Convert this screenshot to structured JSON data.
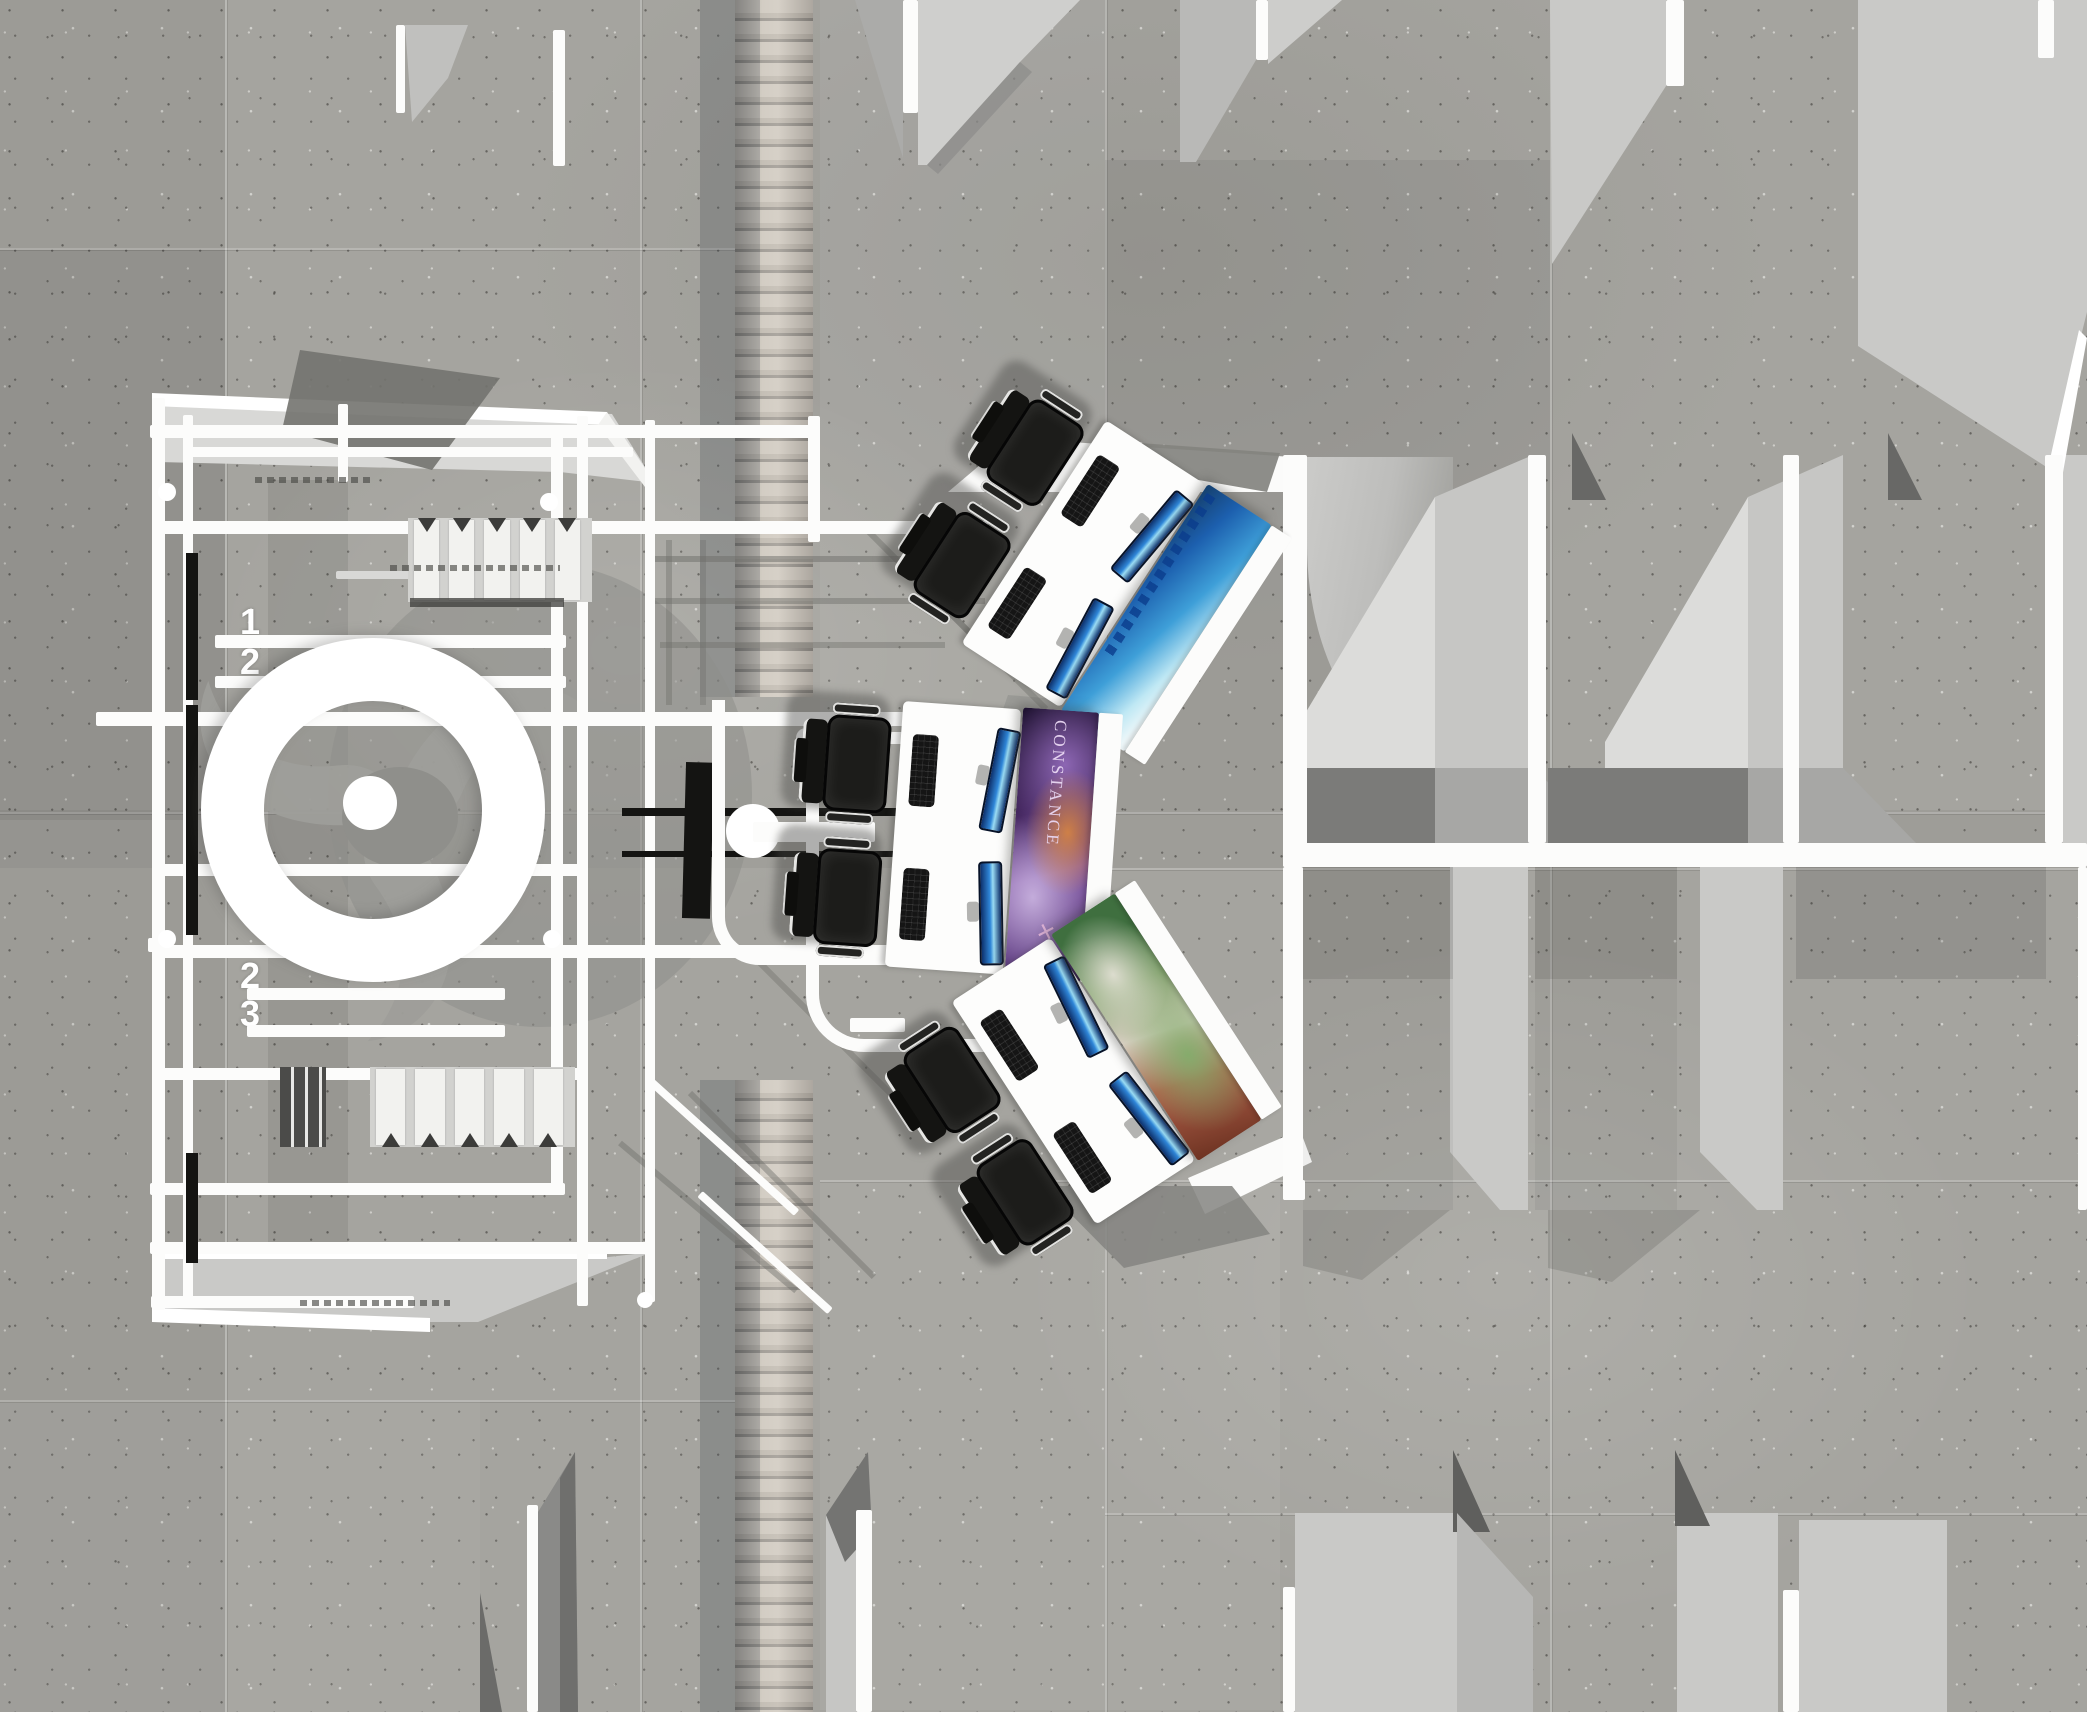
{
  "meta": {
    "scene": "top-down 3d render of exhibition gaming booth floor plan",
    "view": "plan"
  },
  "canvas": {
    "w": 2087,
    "h": 1712
  },
  "palette": {
    "concrete": "#a5a49f",
    "white": "#fcfcfb",
    "light_panel": "#c9c9c7",
    "mid_gray": "#a7a7a5",
    "dark_shadow": "#7b7b79",
    "chair_black": "#1c1c1a",
    "monitor_blue": "#2f86d8",
    "monitor_glow": "#9adcf4",
    "wood_light": "#c9c2b8",
    "poster_purple": "#7a4f9e",
    "poster_blue": "#3e9fd8",
    "poster_green": "#7fa06a"
  },
  "floor": {
    "seams_v": [
      {
        "x": 225,
        "y": 0,
        "h": 1712
      },
      {
        "x": 640,
        "y": 0,
        "h": 1712
      },
      {
        "x": 1105,
        "y": 0,
        "h": 1712
      },
      {
        "x": 1550,
        "y": 0,
        "h": 1712
      }
    ],
    "seams_h": [
      {
        "y": 248,
        "x": 0,
        "w": 735
      },
      {
        "y": 812,
        "x": 0,
        "w": 2087
      },
      {
        "y": 868,
        "x": 1105,
        "w": 982
      },
      {
        "y": 1180,
        "x": 820,
        "w": 1267
      },
      {
        "y": 1400,
        "x": 0,
        "w": 735
      },
      {
        "y": 1513,
        "x": 1105,
        "w": 982
      }
    ],
    "tones": [
      {
        "x": 0,
        "y": 0,
        "w": 225,
        "h": 1712,
        "c": "#000000",
        "o": 0.05
      },
      {
        "x": 0,
        "y": 250,
        "w": 225,
        "h": 570,
        "c": "#000000",
        "o": 0.06
      },
      {
        "x": 820,
        "y": 0,
        "w": 285,
        "h": 810,
        "c": "#ffffff",
        "o": 0.05
      },
      {
        "x": 1105,
        "y": 160,
        "w": 445,
        "h": 650,
        "c": "#000000",
        "o": 0.05
      },
      {
        "x": 0,
        "y": 810,
        "w": 2087,
        "h": 58,
        "c": "#000000",
        "o": 0.04
      },
      {
        "x": 820,
        "y": 1180,
        "w": 460,
        "h": 530,
        "c": "#ffffff",
        "o": 0.05
      },
      {
        "x": 0,
        "y": 1400,
        "w": 480,
        "h": 312,
        "c": "#ffffff",
        "o": 0.04
      },
      {
        "x": 268,
        "y": 480,
        "w": 80,
        "h": 770,
        "c": "#000000",
        "o": 0.08
      }
    ]
  },
  "walkway": {
    "x": 735,
    "w": 78,
    "segments": [
      {
        "y": 0,
        "h": 697
      },
      {
        "y": 1080,
        "h": 632
      }
    ],
    "shadow_x": 700,
    "shadow_w": 60
  },
  "booth": {
    "numbers": [
      {
        "label": "1",
        "x": 240,
        "y": 604
      },
      {
        "label": "2",
        "x": 240,
        "y": 644
      },
      {
        "label": "2",
        "x": 240,
        "y": 958
      },
      {
        "label": "3",
        "x": 240,
        "y": 996
      }
    ],
    "beams_h": [
      {
        "x": 150,
        "y": 425,
        "w": 662,
        "h": 13
      },
      {
        "x": 183,
        "y": 447,
        "w": 450,
        "h": 10
      },
      {
        "x": 163,
        "y": 521,
        "w": 825,
        "h": 13
      },
      {
        "x": 336,
        "y": 571,
        "w": 246,
        "h": 8,
        "c": "#d8d8d6"
      },
      {
        "x": 215,
        "y": 635,
        "w": 351,
        "h": 13
      },
      {
        "x": 215,
        "y": 676,
        "w": 351,
        "h": 12
      },
      {
        "x": 96,
        "y": 712,
        "w": 812,
        "h": 14
      },
      {
        "x": 820,
        "y": 732,
        "w": 92,
        "h": 12
      },
      {
        "x": 163,
        "y": 864,
        "w": 419,
        "h": 12
      },
      {
        "x": 163,
        "y": 945,
        "w": 745,
        "h": 13
      },
      {
        "x": 247,
        "y": 988,
        "w": 258,
        "h": 12
      },
      {
        "x": 247,
        "y": 1025,
        "w": 258,
        "h": 12
      },
      {
        "x": 163,
        "y": 1068,
        "w": 419,
        "h": 12
      },
      {
        "x": 150,
        "y": 1183,
        "w": 415,
        "h": 12
      },
      {
        "x": 150,
        "y": 1242,
        "w": 497,
        "h": 12
      },
      {
        "x": 151,
        "y": 1296,
        "w": 263,
        "h": 12
      },
      {
        "x": 850,
        "y": 1018,
        "w": 55,
        "h": 14
      },
      {
        "x": 148,
        "y": 938,
        "w": 18,
        "h": 14
      }
    ],
    "beams_v": [
      {
        "x": 152,
        "y": 398,
        "w": 13,
        "h": 912
      },
      {
        "x": 183,
        "y": 415,
        "w": 10,
        "h": 886
      },
      {
        "x": 338,
        "y": 404,
        "w": 10,
        "h": 78
      },
      {
        "x": 551,
        "y": 428,
        "w": 12,
        "h": 762
      },
      {
        "x": 577,
        "y": 416,
        "w": 11,
        "h": 890
      },
      {
        "x": 645,
        "y": 420,
        "w": 10,
        "h": 882
      },
      {
        "x": 808,
        "y": 416,
        "w": 12,
        "h": 126
      },
      {
        "x": 553,
        "y": 30,
        "w": 12,
        "h": 136
      },
      {
        "x": 396,
        "y": 25,
        "w": 9,
        "h": 88
      }
    ],
    "diag_white": [
      {
        "x": 648,
        "y": 1075,
        "w": 200,
        "h": 8,
        "rot": 42
      },
      {
        "x": 700,
        "y": 1190,
        "w": 175,
        "h": 8,
        "rot": 42
      }
    ],
    "diag_gray": [
      {
        "x": 650,
        "y": 556,
        "w": 335,
        "h": 6,
        "rot": 0,
        "o": 0.5
      },
      {
        "x": 650,
        "y": 598,
        "w": 335,
        "h": 6,
        "rot": 0,
        "o": 0.45
      },
      {
        "x": 660,
        "y": 642,
        "w": 285,
        "h": 6,
        "rot": 0,
        "o": 0.4
      },
      {
        "x": 860,
        "y": 520,
        "w": 170,
        "h": 6,
        "rot": 45,
        "o": 0.45
      },
      {
        "x": 940,
        "y": 600,
        "w": 150,
        "h": 6,
        "rot": 45,
        "o": 0.4
      },
      {
        "x": 690,
        "y": 1090,
        "w": 260,
        "h": 6,
        "rot": 45,
        "o": 0.45
      },
      {
        "x": 760,
        "y": 960,
        "w": 200,
        "h": 6,
        "rot": 45,
        "o": 0.4
      },
      {
        "x": 620,
        "y": 1140,
        "w": 230,
        "h": 6,
        "rot": 40,
        "o": 0.45
      },
      {
        "x": 666,
        "y": 540,
        "w": 6,
        "h": 165,
        "rot": 0,
        "o": 0.4
      },
      {
        "x": 700,
        "y": 540,
        "w": 6,
        "h": 165,
        "rot": 0,
        "o": 0.35
      }
    ],
    "black_bars": [
      {
        "x": 186,
        "y": 553,
        "w": 12,
        "h": 147
      },
      {
        "x": 186,
        "y": 705,
        "w": 12,
        "h": 230
      },
      {
        "x": 186,
        "y": 1153,
        "w": 12,
        "h": 110
      },
      {
        "x": 684,
        "y": 762,
        "w": 28,
        "h": 156,
        "rot": 1.5
      },
      {
        "x": 622,
        "y": 808,
        "w": 283,
        "h": 8
      },
      {
        "x": 622,
        "y": 851,
        "w": 283,
        "h": 6
      }
    ],
    "dots": [
      {
        "x": 167,
        "y": 492,
        "d": 18
      },
      {
        "x": 549,
        "y": 502,
        "d": 18
      },
      {
        "x": 167,
        "y": 939,
        "d": 18
      },
      {
        "x": 552,
        "y": 939,
        "d": 18
      },
      {
        "x": 806,
        "y": 738,
        "d": 20
      },
      {
        "x": 645,
        "y": 1300,
        "d": 16
      }
    ],
    "ball": {
      "x": 726,
      "y": 804,
      "d": 54,
      "bar": {
        "x": 753,
        "y": 822,
        "w": 122,
        "h": 20
      }
    },
    "ring": {
      "cx": 373,
      "cy": 810,
      "outer_r": 172,
      "band": 63
    },
    "uframes": [
      {
        "x": 712,
        "y": 700,
        "w": 196,
        "h": 252,
        "r": 48
      },
      {
        "x": 806,
        "y": 745,
        "w": 269,
        "h": 294,
        "r": 58
      }
    ],
    "louvers": [
      {
        "x": 408,
        "y": 518,
        "w": 184,
        "h": 84,
        "slats": 5,
        "tri": "down",
        "bar": true
      },
      {
        "x": 370,
        "y": 1067,
        "w": 205,
        "h": 80,
        "slats": 5,
        "tri": "up",
        "bar": false
      }
    ],
    "striped_panel": {
      "x": 280,
      "y": 1067,
      "w": 46,
      "h": 80
    },
    "microdash": [
      {
        "x": 255,
        "y": 477,
        "w": 120,
        "h": 6
      },
      {
        "x": 390,
        "y": 565,
        "w": 170,
        "h": 6
      },
      {
        "x": 300,
        "y": 1300,
        "w": 150,
        "h": 6
      }
    ]
  },
  "gaming_zone": {
    "poster_title": "CONSTANCE",
    "poster_mark": "✕",
    "groups": [
      {
        "cx": 1085,
        "cy": 565,
        "rot": 33,
        "panel": "winter"
      },
      {
        "cx": 955,
        "cy": 838,
        "rot": 4,
        "panel": "constance"
      },
      {
        "cx": 1075,
        "cy": 1080,
        "rot": -33,
        "panel": "forest"
      }
    ]
  },
  "rooms": {
    "white_bands": [
      {
        "x": 1283,
        "y": 455,
        "w": 24,
        "h": 412
      },
      {
        "x": 1528,
        "y": 455,
        "w": 18,
        "h": 388
      },
      {
        "x": 1783,
        "y": 455,
        "w": 16,
        "h": 388
      },
      {
        "x": 2045,
        "y": 455,
        "w": 18,
        "h": 388
      },
      {
        "x": 1283,
        "y": 843,
        "w": 804,
        "h": 24
      },
      {
        "x": 1283,
        "y": 867,
        "w": 20,
        "h": 333
      },
      {
        "x": 2078,
        "y": 867,
        "w": 9,
        "h": 343
      },
      {
        "x": 903,
        "y": 0,
        "w": 15,
        "h": 113
      },
      {
        "x": 1256,
        "y": 0,
        "w": 12,
        "h": 60
      },
      {
        "x": 1666,
        "y": 0,
        "w": 18,
        "h": 86
      },
      {
        "x": 2038,
        "y": 0,
        "w": 16,
        "h": 58
      },
      {
        "x": 527,
        "y": 1505,
        "w": 11,
        "h": 207
      },
      {
        "x": 856,
        "y": 1510,
        "w": 16,
        "h": 202
      },
      {
        "x": 1283,
        "y": 1587,
        "w": 12,
        "h": 125
      },
      {
        "x": 1783,
        "y": 1590,
        "w": 16,
        "h": 122
      },
      {
        "x": 1283,
        "y": 1180,
        "w": 22,
        "h": 20
      }
    ],
    "dark_bands": [
      {
        "x": 1303,
        "y": 867,
        "w": 150,
        "h": 112,
        "o": 0.18
      },
      {
        "x": 1535,
        "y": 867,
        "w": 142,
        "h": 112,
        "o": 0.18
      },
      {
        "x": 1796,
        "y": 867,
        "w": 250,
        "h": 112,
        "o": 0.14
      },
      {
        "x": 1303,
        "y": 979,
        "w": 150,
        "h": 231,
        "o": 0.06
      },
      {
        "x": 1535,
        "y": 979,
        "w": 142,
        "h": 231,
        "o": 0.06
      }
    ],
    "light_rects": [
      {
        "x": 2063,
        "y": 455,
        "w": 24,
        "h": 390,
        "c": "#c9c9c7"
      },
      {
        "x": 1295,
        "y": 1513,
        "w": 162,
        "h": 199,
        "c": "#c9c9c7"
      },
      {
        "x": 1677,
        "y": 1513,
        "w": 101,
        "h": 199,
        "c": "#c9c9c7"
      },
      {
        "x": 1799,
        "y": 1520,
        "w": 148,
        "h": 192,
        "c": "#c9c9c7"
      }
    ],
    "ramp": {
      "x": 1307,
      "y": 457,
      "w": 146,
      "h": 311
    }
  },
  "svg_shapes": [
    {
      "n": "slab-top-left",
      "p": "405,25 468,25 448,78 412,122",
      "f": "#c0c0be"
    },
    {
      "n": "wedge-top-left",
      "p": "855,0 903,0 903,158",
      "f": "#ababa9"
    },
    {
      "n": "slab-top-right",
      "p": "918,0 1080,0 1020,62 927,165 918,165",
      "f": "#cfcfcd"
    },
    {
      "n": "slab-top-right-shadow",
      "p": "927,165 1020,62 1032,72 938,174",
      "f": "#8c8c8a",
      "o": 0.7
    },
    {
      "n": "slab-pair-left",
      "p": "1180,0 1256,0 1256,60 1196,162 1180,162",
      "f": "#b9b9b7"
    },
    {
      "n": "slab-pair-right",
      "p": "1268,0 1342,0 1268,64",
      "f": "#cdcdcb"
    },
    {
      "n": "floor-tr-a",
      "p": "1550,0 1666,0 1666,86 1552,264",
      "f": "#c9c9c7"
    },
    {
      "n": "floor-tr-b",
      "p": "1858,0 2087,0 2087,312 2048,468 1858,346",
      "f": "#c9c9c7"
    },
    {
      "n": "floor-tr-b-sliver",
      "p": "2048,468 2079,330 2087,338 2062,478",
      "f": "#ffffff"
    },
    {
      "n": "tip-row1-a",
      "p": "1572,433 1606,500 1572,500",
      "f": "#686866"
    },
    {
      "n": "tip-row1-b",
      "p": "1888,433 1922,500 1888,500",
      "f": "#686866"
    },
    {
      "n": "wall-a-bright",
      "p": "1288,742 1435,497 1435,768 1288,768",
      "f": "#dcdcda"
    },
    {
      "n": "wall-a-side",
      "p": "1435,497 1533,455 1533,768 1435,768",
      "f": "#c6c6c4"
    },
    {
      "n": "band-a-dark",
      "p": "1288,768 1435,768 1435,843 1288,843",
      "f": "#7b7b79"
    },
    {
      "n": "band-a-light",
      "p": "1435,768 1533,768 1612,843 1435,843",
      "f": "#a7a7a5"
    },
    {
      "n": "wall-b-bright",
      "p": "1605,742 1748,497 1748,768 1605,768",
      "f": "#dcdcda"
    },
    {
      "n": "wall-b-side",
      "p": "1748,497 1843,455 1843,768 1748,768",
      "f": "#c6c6c4"
    },
    {
      "n": "band-b-dark",
      "p": "1548,768 1748,768 1748,843 1548,843",
      "f": "#7b7b79"
    },
    {
      "n": "band-b-light",
      "p": "1748,768 1843,768 1916,843 1748,843",
      "f": "#a7a7a5"
    },
    {
      "n": "wall-row2-a",
      "p": "1450,867 1528,867 1528,1210 1500,1210 1450,1152",
      "f": "#c9c9c7"
    },
    {
      "n": "wall-row2-b",
      "p": "1700,867 1783,867 1783,1210 1757,1210 1700,1152",
      "f": "#c9c9c7"
    },
    {
      "n": "shadow-row2-a",
      "p": "1303,1210 1450,1210 1362,1280 1303,1266",
      "f": "#5a5a58",
      "o": 0.25
    },
    {
      "n": "shadow-row2-b",
      "p": "1548,1210 1700,1210 1612,1282 1548,1268",
      "f": "#5a5a58",
      "o": 0.25
    },
    {
      "n": "tip-row3-a",
      "p": "1453,1450 1490,1532 1453,1532",
      "f": "#5f5f5d"
    },
    {
      "n": "tip-row3-b",
      "p": "1675,1450 1710,1526 1675,1526",
      "f": "#5f5f5d"
    },
    {
      "n": "floor-row3-mid",
      "p": "1457,1513 1533,1597 1533,1712 1457,1712",
      "f": "#b7b7b5"
    },
    {
      "n": "bottom-wall-left",
      "p": "538,1512 575,1452 578,1712 538,1712",
      "f": "#8a8a88"
    },
    {
      "n": "bottom-wall-left-dark",
      "p": "560,1478 575,1452 578,1712 560,1712",
      "f": "#6f6f6d"
    },
    {
      "n": "bottom-wall-right-light",
      "p": "826,1515 856,1540 856,1712 826,1712",
      "f": "#c6c6c4"
    },
    {
      "n": "bottom-wall-right-dark",
      "p": "826,1515 868,1452 872,1532 845,1562",
      "f": "#747472"
    },
    {
      "n": "bottom-wall-far-left",
      "p": "480,1593 502,1712 480,1712",
      "f": "#6b6b69"
    },
    {
      "n": "awning-fill",
      "p": "158,396 612,414 655,483 560,472 158,462",
      "f": "#d8d8d6"
    },
    {
      "n": "awning-band",
      "p": "152,393 607,412 607,425 152,406",
      "f": "#ffffff"
    },
    {
      "n": "awning-diag",
      "p": "607,412 655,483 645,487 598,425",
      "f": "#f2f2f0"
    },
    {
      "n": "shadow-diamond",
      "p": "300,350 500,378 432,470 282,430",
      "f": "#73736f",
      "o": 0.9
    },
    {
      "n": "platform-fill",
      "p": "152,1258 600,1258 652,1252 478,1322 152,1322",
      "f": "#c9c9c7"
    },
    {
      "n": "platform-band-1",
      "p": "152,1247 607,1247 607,1259 152,1259",
      "f": "#ffffff"
    },
    {
      "n": "platform-band-2",
      "p": "152,1308 430,1318 430,1332 152,1322",
      "f": "#ffffff"
    },
    {
      "n": "connector-top-white",
      "p": "948,492 1012,438 1307,458 1307,492 1180,492",
      "f": "#fbfbfa"
    },
    {
      "n": "flag-shadow-top",
      "p": "1097,440 1280,453 1267,492 1130,468",
      "f": "#83837f",
      "o": 0.92
    },
    {
      "n": "wedge-desk-1",
      "p": "1008,695 1090,702 1046,726 1000,718",
      "f": "#9a9a96"
    },
    {
      "n": "wedge-desk-2",
      "p": "952,928 1040,935 1010,958 948,950",
      "f": "#9a9a96"
    },
    {
      "n": "connector-bottom-white",
      "p": "1188,1178 1300,1130 1312,1162 1205,1214",
      "f": "#fbfbfa"
    },
    {
      "n": "shadow-desk-bottom",
      "p": "1043,1186 1232,1186 1270,1234 1124,1268",
      "f": "#848480",
      "o": 0.85
    }
  ]
}
